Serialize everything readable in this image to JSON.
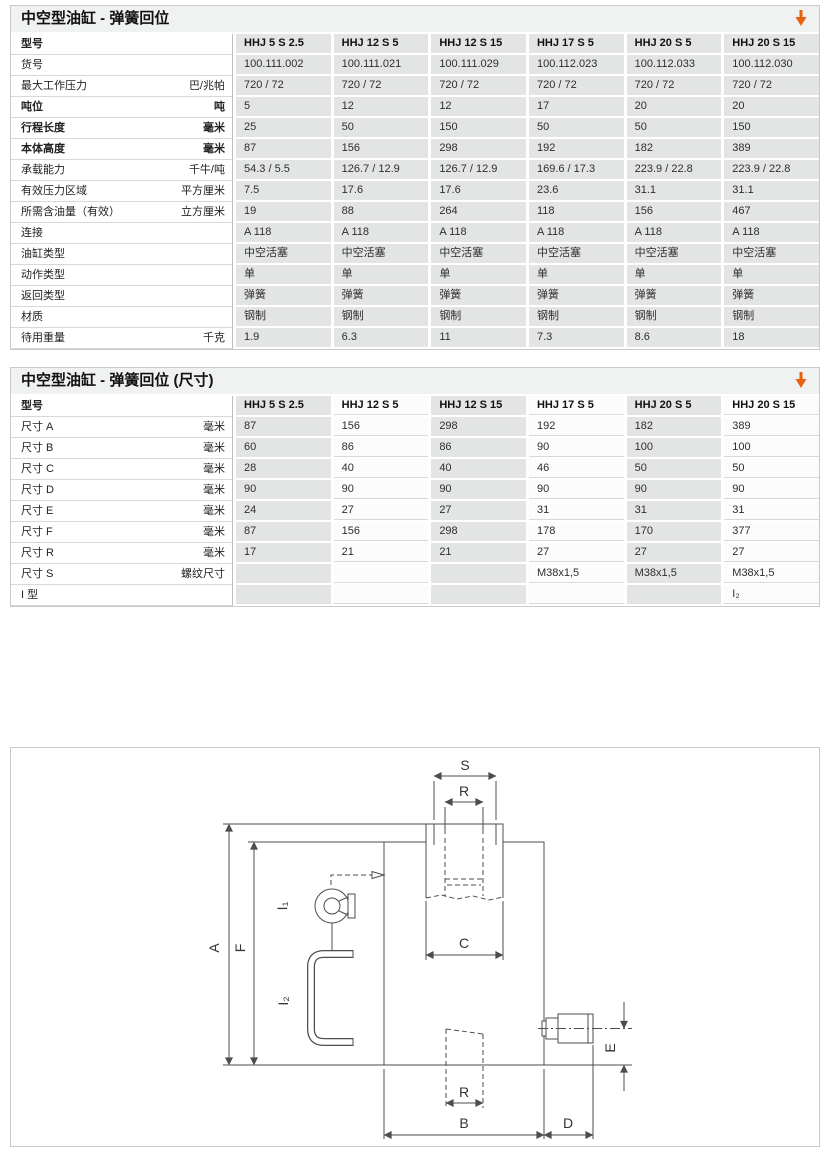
{
  "colors": {
    "accent_orange": "#e8610e",
    "cell_grey": "#e3e4e4",
    "titlebar_grey": "#f0f1f1",
    "border_grey": "#c9c9c9"
  },
  "tables": [
    {
      "title": "中空型油缸 - 弹簧回位",
      "header_label": "型号",
      "alternate_columns": false,
      "columns": [
        "HHJ 5 S 2.5",
        "HHJ 12 S 5",
        "HHJ 12 S 15",
        "HHJ 17 S 5",
        "HHJ 20 S 5",
        "HHJ 20 S 15"
      ],
      "rows": [
        {
          "label": "货号",
          "unit": "",
          "bold": false,
          "values": [
            "100.111.002",
            "100.111.021",
            "100.111.029",
            "100.112.023",
            "100.112.033",
            "100.112.030"
          ]
        },
        {
          "label": "最大工作压力",
          "unit": "巴/兆帕",
          "bold": false,
          "values": [
            "720 / 72",
            "720 / 72",
            "720 / 72",
            "720 / 72",
            "720 / 72",
            "720 / 72"
          ]
        },
        {
          "label": "吨位",
          "unit": "吨",
          "bold": true,
          "values": [
            "5",
            "12",
            "12",
            "17",
            "20",
            "20"
          ]
        },
        {
          "label": "行程长度",
          "unit": "毫米",
          "bold": true,
          "values": [
            "25",
            "50",
            "150",
            "50",
            "50",
            "150"
          ]
        },
        {
          "label": "本体高度",
          "unit": "毫米",
          "bold": true,
          "values": [
            "87",
            "156",
            "298",
            "192",
            "182",
            "389"
          ]
        },
        {
          "label": "承载能力",
          "unit": "千牛/吨",
          "bold": false,
          "values": [
            "54.3 / 5.5",
            "126.7 / 12.9",
            "126.7 / 12.9",
            "169.6 / 17.3",
            "223.9 / 22.8",
            "223.9 / 22.8"
          ]
        },
        {
          "label": "有效压力区域",
          "unit": "平方厘米",
          "bold": false,
          "values": [
            "7.5",
            "17.6",
            "17.6",
            "23.6",
            "31.1",
            "31.1"
          ]
        },
        {
          "label": "所需含油量（有效）",
          "unit": "立方厘米",
          "bold": false,
          "values": [
            "19",
            "88",
            "264",
            "118",
            "156",
            "467"
          ]
        },
        {
          "label": "连接",
          "unit": "",
          "bold": false,
          "values": [
            "A 118",
            "A 118",
            "A 118",
            "A 118",
            "A 118",
            "A 118"
          ]
        },
        {
          "label": "油缸类型",
          "unit": "",
          "bold": false,
          "values": [
            "中空活塞",
            "中空活塞",
            "中空活塞",
            "中空活塞",
            "中空活塞",
            "中空活塞"
          ]
        },
        {
          "label": "动作类型",
          "unit": "",
          "bold": false,
          "values": [
            "单",
            "单",
            "单",
            "单",
            "单",
            "单"
          ]
        },
        {
          "label": "返回类型",
          "unit": "",
          "bold": false,
          "values": [
            "弹簧",
            "弹簧",
            "弹簧",
            "弹簧",
            "弹簧",
            "弹簧"
          ]
        },
        {
          "label": "材质",
          "unit": "",
          "bold": false,
          "values": [
            "钢制",
            "钢制",
            "钢制",
            "钢制",
            "钢制",
            "钢制"
          ]
        },
        {
          "label": "待用重量",
          "unit": "千克",
          "bold": false,
          "values": [
            "1.9",
            "6.3",
            "11",
            "7.3",
            "8.6",
            "18"
          ]
        }
      ]
    },
    {
      "title": "中空型油缸 - 弹簧回位 (尺寸)",
      "header_label": "型号",
      "alternate_columns": true,
      "columns": [
        "HHJ 5 S 2.5",
        "HHJ 12 S 5",
        "HHJ 12 S 15",
        "HHJ 17 S 5",
        "HHJ 20 S 5",
        "HHJ 20 S 15"
      ],
      "rows": [
        {
          "label": "尺寸 A",
          "unit": "毫米",
          "bold": false,
          "values": [
            "87",
            "156",
            "298",
            "192",
            "182",
            "389"
          ]
        },
        {
          "label": "尺寸 B",
          "unit": "毫米",
          "bold": false,
          "values": [
            "60",
            "86",
            "86",
            "90",
            "100",
            "100"
          ]
        },
        {
          "label": "尺寸 C",
          "unit": "毫米",
          "bold": false,
          "values": [
            "28",
            "40",
            "40",
            "46",
            "50",
            "50"
          ]
        },
        {
          "label": "尺寸 D",
          "unit": "毫米",
          "bold": false,
          "values": [
            "90",
            "90",
            "90",
            "90",
            "90",
            "90"
          ]
        },
        {
          "label": "尺寸 E",
          "unit": "毫米",
          "bold": false,
          "values": [
            "24",
            "27",
            "27",
            "31",
            "31",
            "31"
          ]
        },
        {
          "label": "尺寸 F",
          "unit": "毫米",
          "bold": false,
          "values": [
            "87",
            "156",
            "298",
            "178",
            "170",
            "377"
          ]
        },
        {
          "label": "尺寸 R",
          "unit": "毫米",
          "bold": false,
          "values": [
            "17",
            "21",
            "21",
            "27",
            "27",
            "27"
          ]
        },
        {
          "label": "尺寸 S",
          "unit": "螺纹尺寸",
          "bold": false,
          "values": [
            "",
            "",
            "",
            "M38x1,5",
            "M38x1,5",
            "M38x1,5"
          ]
        },
        {
          "label": "I 型",
          "unit": "",
          "bold": false,
          "values": [
            "",
            "",
            "",
            "",
            "",
            "I₂"
          ]
        }
      ]
    }
  ],
  "diagram": {
    "labels": {
      "s": "S",
      "r_top": "R",
      "c": "C",
      "a": "A",
      "f": "F",
      "i1": "I₁",
      "i2": "I₂",
      "e": "E",
      "r_bottom": "R",
      "b": "B",
      "d": "D"
    }
  }
}
